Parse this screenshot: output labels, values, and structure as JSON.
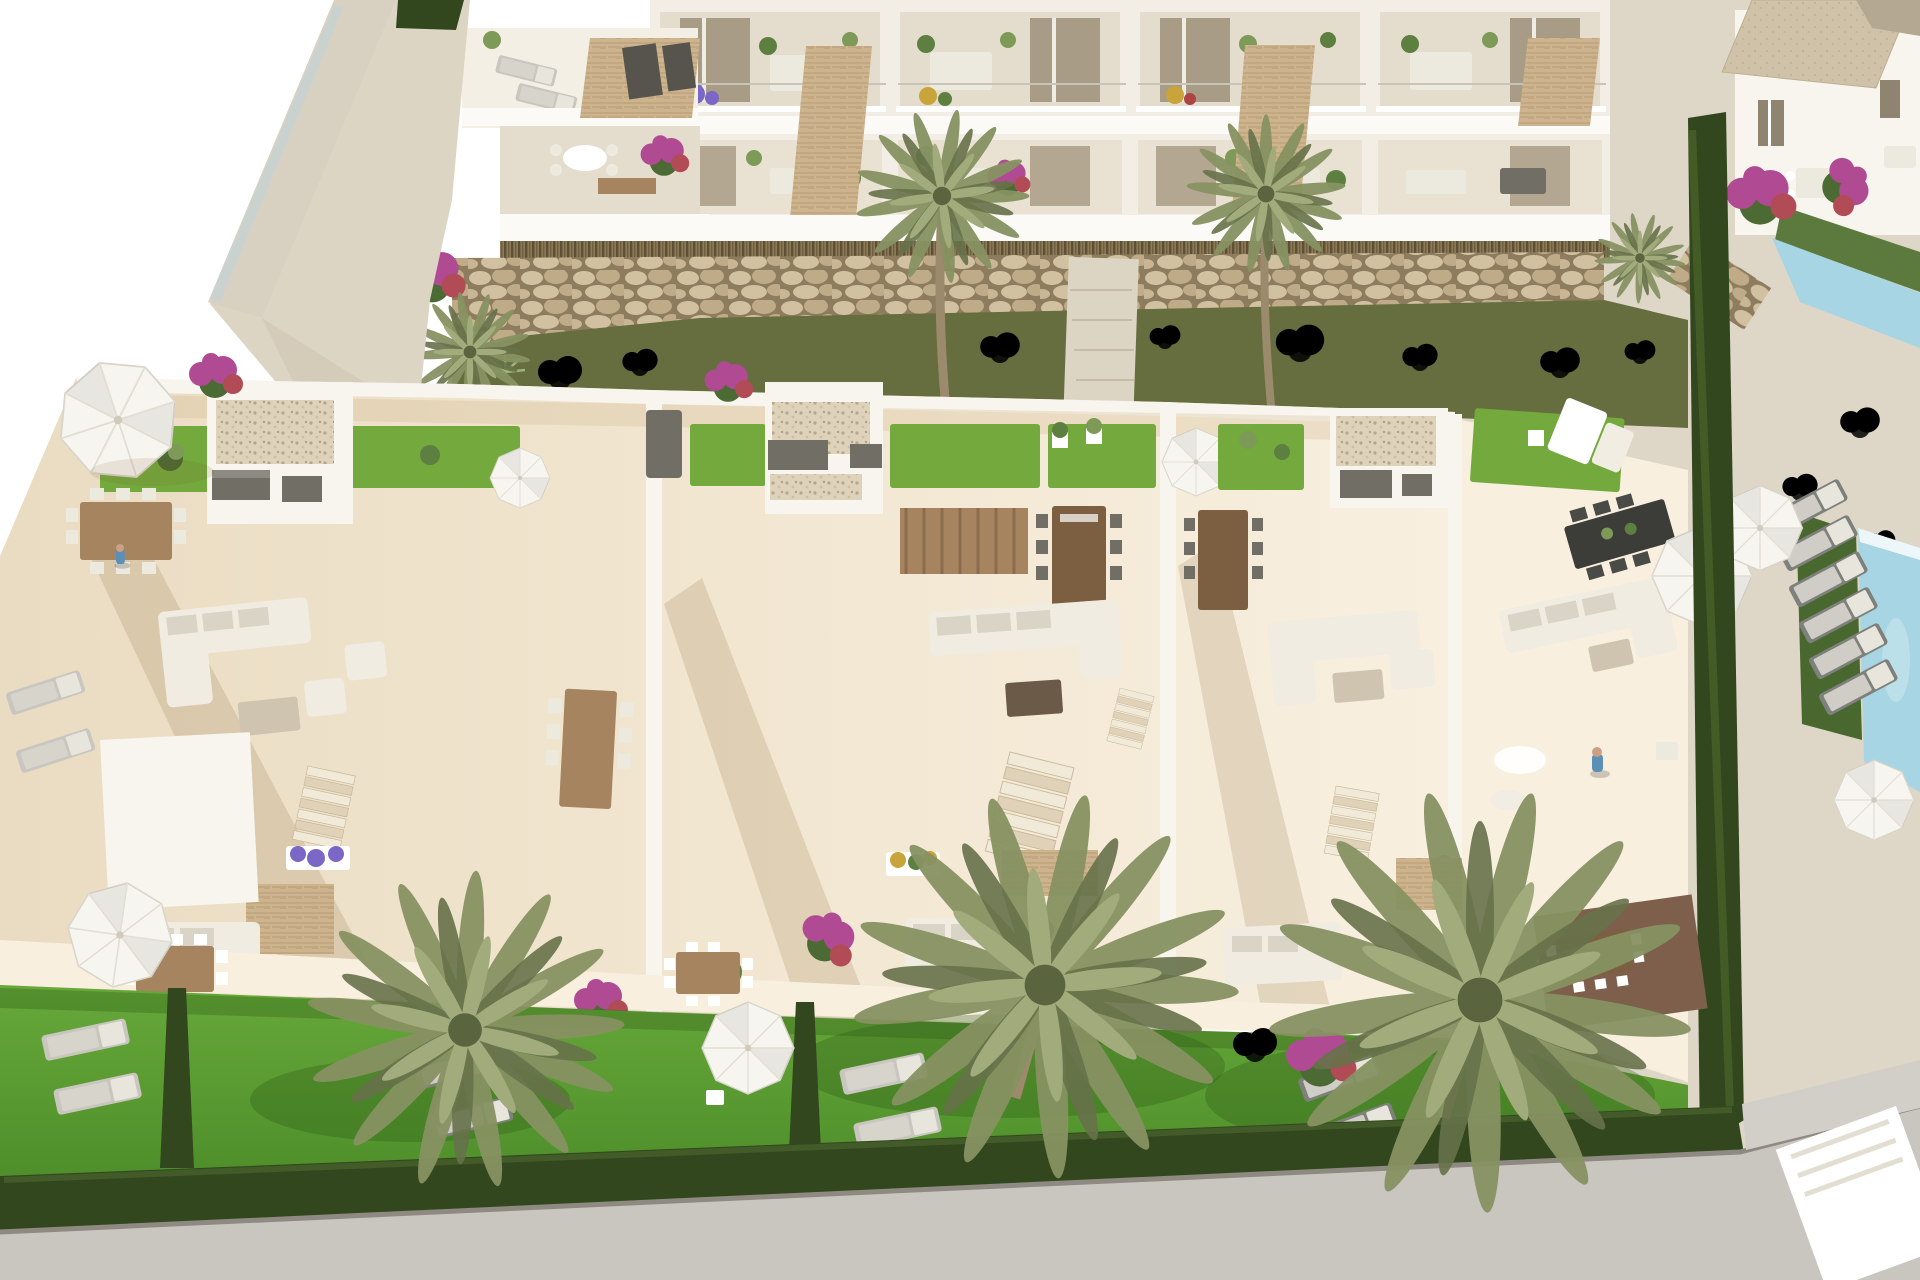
{
  "scene": {
    "kind": "architectural-3d-aerial-render",
    "subject": "new-build white Mediterranean townhouse row with rooftop solarium terraces, private lawned gardens, palm trees, sun loungers and pools",
    "visible_text": []
  },
  "palette": {
    "page_bg": "#ffffff",
    "facade_white": "#f2eee6",
    "facade_recess": "#e4dccd",
    "wall_white": "#f8f5ee",
    "slab_white": "#fbfaf6",
    "glass_door": "#a99c86",
    "window_dark": "#8f846f",
    "stone_clad": "#cdb48e",
    "stone_clad_line": "#b1966c",
    "reed_band": "#8a7a56",
    "reed_line": "#57492f",
    "rock_base": "#8d7c5d",
    "rock_stone": "#d2c1a0",
    "rock_stone2": "#bfab87",
    "olive_grass": "#666d3e",
    "olive_dark": "#4c5430",
    "turf_green": "#74a93d",
    "lawn_green": "#5d9c33",
    "lawn_shadow": "#3a7420",
    "hedge_dark": "#33471f",
    "terrace_cream": "#f1e6d1",
    "terrace_sun": "#f8efdf",
    "gravel": "#ded2ba",
    "gravel_dot": "#b5a78a",
    "wood": "#a5845f",
    "wood_dark": "#7c5f41",
    "furniture_light": "#eceadf",
    "furniture_frame": "#97948c",
    "sofa_white": "#f0ece1",
    "cushion": "#d9d4c6",
    "gray_box": "#716e66",
    "gray_box_dark": "#57544d",
    "lounger_gray": "#7e807c",
    "lounger_pale": "#c9c6bf",
    "parasol_white": "#f7f5ef",
    "pool_blue": "#a7d5e3",
    "pool_deep": "#86bfd2",
    "road_gray": "#c9c6c0",
    "curb": "#8e8a82",
    "path_pale": "#ddd5c4",
    "ground_pale": "#ded7c8",
    "palm_light": "#a2ab7c",
    "palm_mid": "#879262",
    "palm_dark": "#67724a",
    "trunk": "#9b8a6b",
    "bougainvillea": "#b04a93",
    "bougainvillea_red": "#b14b55",
    "flower_purple": "#7a67c6",
    "flower_yellow": "#c9a43a",
    "flower_red": "#ad4343",
    "banana_green": "#5f8f4a",
    "person_skin": "#caa187",
    "person_blue": "#5b8fb5"
  },
  "inventory": {
    "townhouse_units_in_row": 4,
    "rooftop_solarium_terraces": 4,
    "background_palm_trees": 2,
    "foreground_palm_trees": 3,
    "white_parasols": 6,
    "garden_sun_lounger_pairs": 3,
    "community_sun_loungers": 6,
    "pools": 2,
    "gabion_rock_walls": 2,
    "hedge_dividers": 3,
    "people": 2
  }
}
